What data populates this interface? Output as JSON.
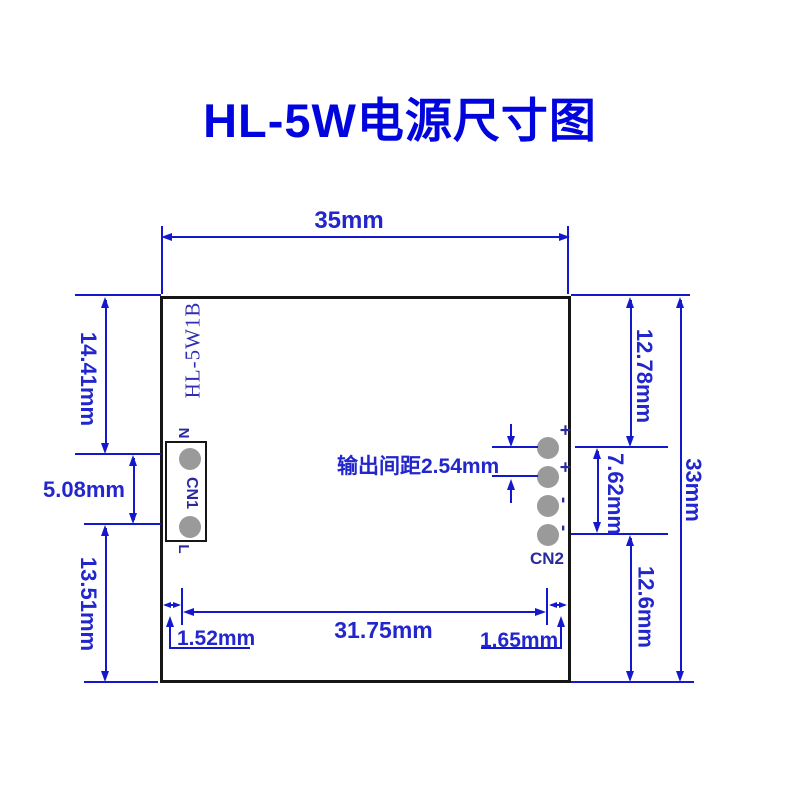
{
  "title": "HL-5W电源尺寸图",
  "board": {
    "silkscreen": "HL-5W1B",
    "cn1": {
      "label": "CN1",
      "pin_top": "N",
      "pin_bottom": "L"
    },
    "cn2": {
      "label": "CN2",
      "polarities": [
        "+",
        "+",
        "-",
        "-"
      ]
    },
    "pitch_note": "输出间距2.54mm"
  },
  "dimensions": {
    "board_width": "35mm",
    "board_height": "33mm",
    "left_top": "14.41mm",
    "left_middle": "5.08mm",
    "left_bottom": "13.51mm",
    "right_top": "12.78mm",
    "right_middle": "7.62mm",
    "right_bottom": "12.6mm",
    "bottom_span": "31.75mm",
    "bottom_left_offset": "1.52mm",
    "bottom_right_offset": "1.65mm"
  },
  "colors": {
    "dimension_blue": "#1418cc",
    "title_blue": "#0004dd",
    "connector_navy": "#2a2a9e",
    "pad_gray": "#9a9a9a",
    "outline_black": "#161616"
  }
}
